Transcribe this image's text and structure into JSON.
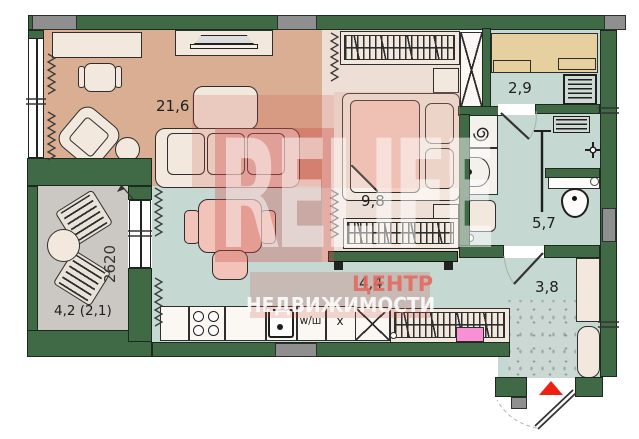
{
  "rooms": {
    "living": {
      "area": "21,6"
    },
    "bedroom": {
      "area": "9,8"
    },
    "dressing": {
      "area": "2,9"
    },
    "bathroom": {
      "area": "5,7"
    },
    "kitchen": {
      "area": "4,4"
    },
    "hallway": {
      "area": "3,8"
    },
    "balcony": {
      "area": "4,2 (2,1)",
      "width_dim": "2620"
    }
  },
  "kitchen": {
    "washer_label": "w/ш",
    "fridge_label": "х"
  },
  "watermark": {
    "logo": "RELIFE",
    "line1": "ЦЕНТР",
    "line2": "НЕДВИЖИМОСТИ"
  },
  "colors": {
    "wall": "#3f6a45",
    "walledge": "#1b2a1d",
    "graypart": "#8f8f8f",
    "livingfloor": "#d9ae92",
    "bedroomfloor": "#eedfd6",
    "wetfloor": "#c6d8d2",
    "balconyfloor": "#cbc8c4",
    "furn": "#f2e8de",
    "furnline": "#2e2e2e",
    "pinkfurn": "#f2c4b9",
    "tanshelf": "#e6d09f",
    "drawerpink": "#f98fd4",
    "accentred": "#ee2111",
    "wmred": "#cc5048"
  }
}
